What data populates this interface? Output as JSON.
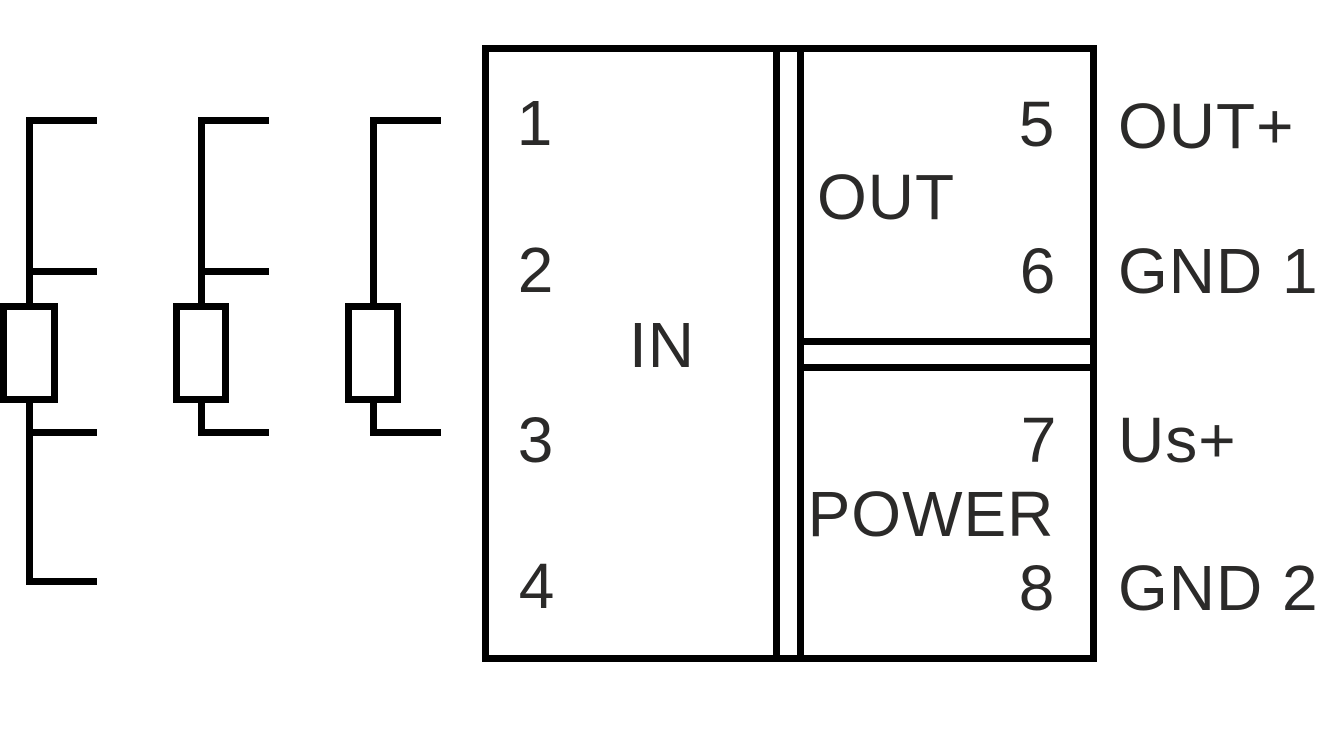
{
  "diagram": {
    "kind": "module-wiring-connection-diagram",
    "module": {
      "in_section": {
        "label": "IN",
        "terminals": [
          {
            "number": "1"
          },
          {
            "number": "2"
          },
          {
            "number": "3"
          },
          {
            "number": "4"
          }
        ]
      },
      "out_section": {
        "label": "OUT",
        "terminals": [
          {
            "number": "5",
            "signal": "OUT+"
          },
          {
            "number": "6",
            "signal": "GND 1"
          }
        ]
      },
      "power_section": {
        "label": "POWER",
        "terminals": [
          {
            "number": "7",
            "signal": "Us+"
          },
          {
            "number": "8",
            "signal": "GND 2"
          }
        ]
      }
    },
    "sensors": [
      {
        "name": "rtd-sensor-4-wire",
        "wires": 4
      },
      {
        "name": "rtd-sensor-3-wire",
        "wires": 3
      },
      {
        "name": "rtd-sensor-2-wire",
        "wires": 2
      }
    ],
    "colors": {
      "line": "#000000",
      "text": "#2b2a29",
      "background": "#ffffff"
    }
  }
}
